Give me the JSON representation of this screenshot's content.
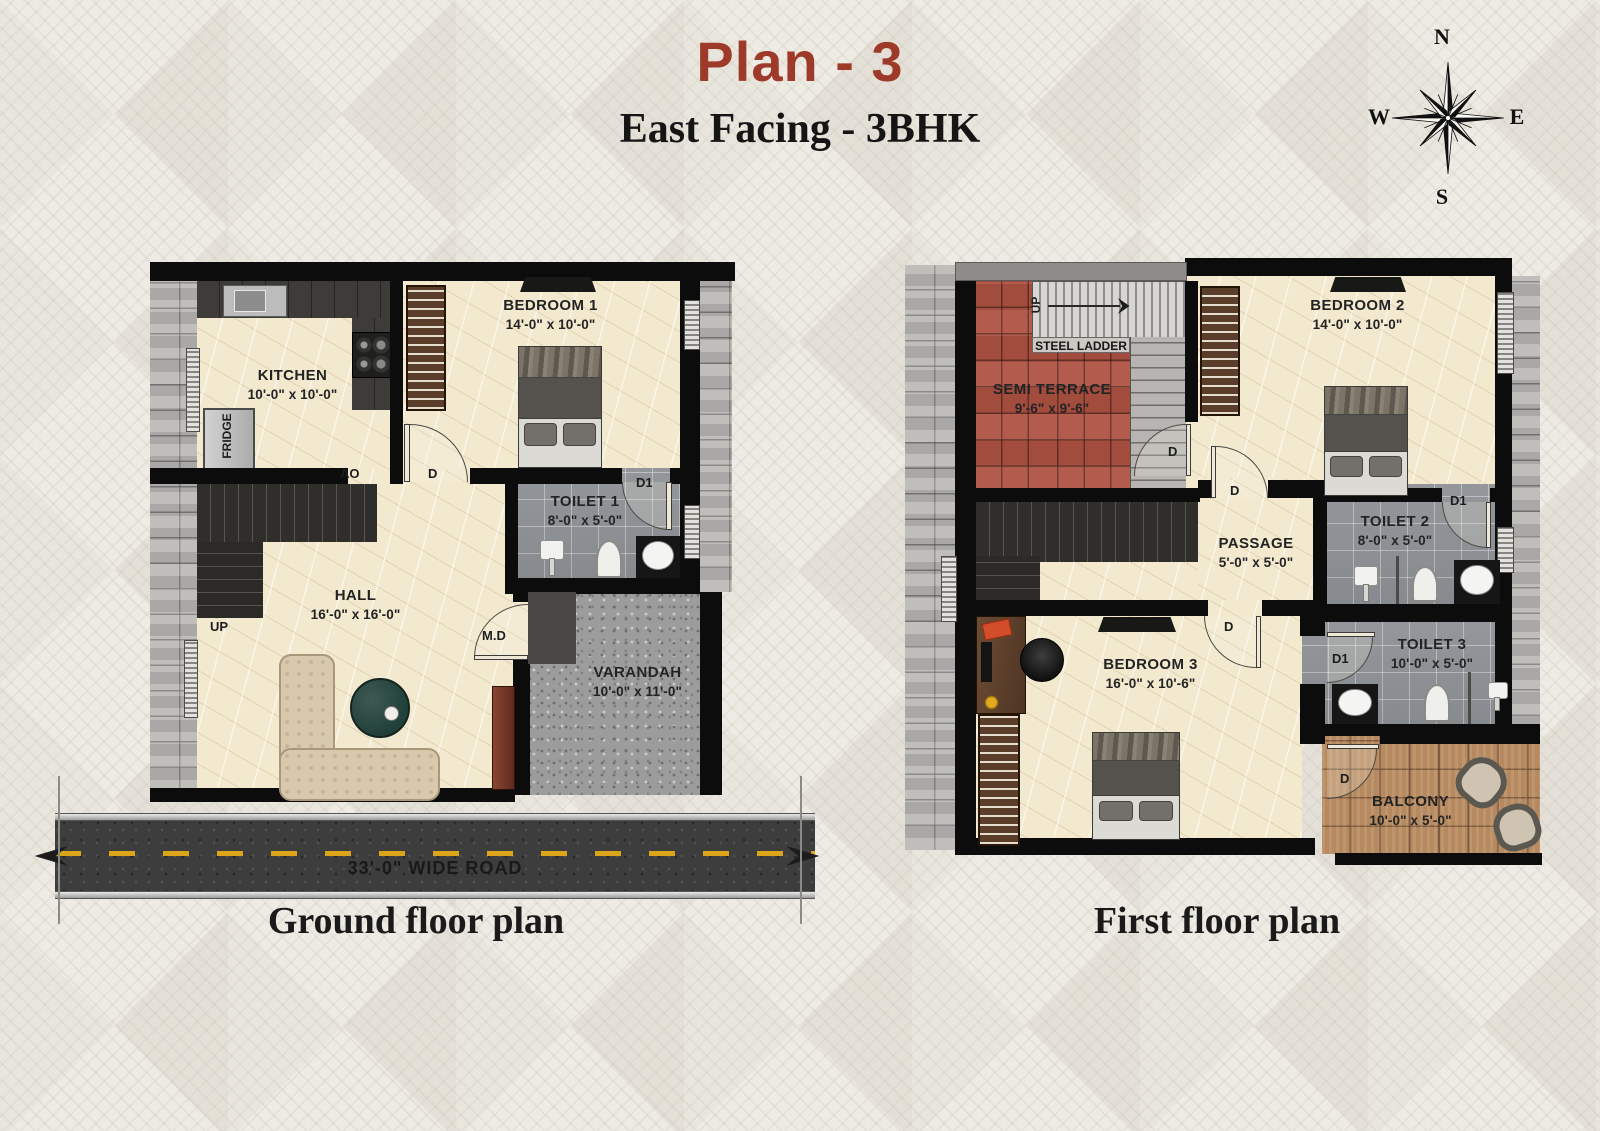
{
  "header": {
    "title": "Plan - 3",
    "subtitle": "East Facing - 3BHK"
  },
  "compass": {
    "north": "N",
    "east": "E",
    "south": "S",
    "west": "W"
  },
  "door_labels": {
    "d": "D",
    "d1": "D1"
  },
  "ground_floor": {
    "caption": "Ground floor plan",
    "road": {
      "label": "33'-0\" WIDE ROAD"
    },
    "rooms": {
      "kitchen": {
        "name": "KITCHEN",
        "size": "10'-0\" x 10'-0\""
      },
      "bedroom1": {
        "name": "BEDROOM 1",
        "size": "14'-0\" x 10'-0\""
      },
      "toilet1": {
        "name": "TOILET 1",
        "size": "8'-0\" x 5'-0\""
      },
      "hall": {
        "name": "HALL",
        "size": "16'-0\" x 16'-0\""
      },
      "varandah": {
        "name": "VARANDAH",
        "size": "10'-0\" x 11'-0\""
      }
    },
    "labels": {
      "fridge": "FRIDGE",
      "up": "UP",
      "ao": "AO",
      "main_door": "M.D"
    }
  },
  "first_floor": {
    "caption": "First floor plan",
    "rooms": {
      "semi_terrace": {
        "name": "SEMI TERRACE",
        "size": "9'-6\" x 9'-6\""
      },
      "bedroom2": {
        "name": "BEDROOM 2",
        "size": "14'-0\" x 10'-0\""
      },
      "toilet2": {
        "name": "TOILET 2",
        "size": "8'-0\" x 5'-0\""
      },
      "passage": {
        "name": "PASSAGE",
        "size": "5'-0\" x 5'-0\""
      },
      "bedroom3": {
        "name": "BEDROOM 3",
        "size": "16'-0\" x 10'-6\""
      },
      "toilet3": {
        "name": "TOILET 3",
        "size": "10'-0\" x 5'-0\""
      },
      "balcony": {
        "name": "BALCONY",
        "size": "10'-0\" x 5'-0\""
      }
    },
    "labels": {
      "steel_ladder": "STEEL LADDER",
      "up": "UP"
    }
  },
  "colors": {
    "title_accent": "#9e3a29",
    "wall": "#0c0c0c",
    "floor_marble": "#f3e9cf",
    "toilet_tile": "#8f9397",
    "terrace_tile": "#ae5242",
    "balcony_wood": "#b6895f",
    "road_asphalt": "#3d3d3d",
    "road_line": "#dca418",
    "stone_cladding": "#b5b3b0"
  }
}
